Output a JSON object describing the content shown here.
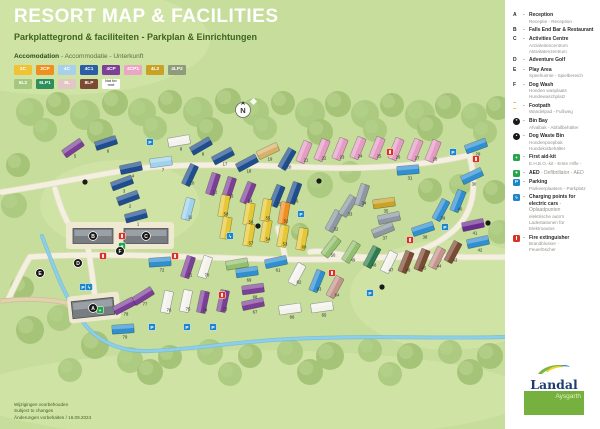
{
  "header": {
    "title": "RESORT MAP & FACILITIES",
    "subtitle": "Parkplattegrond & faciliteiten - Parkplan & Einrichtungen"
  },
  "accommodation": {
    "label_bold": "Accomodation",
    "label_rest": " - Accommodatie - Unterkunft",
    "types": [
      {
        "code": "2C",
        "bg": "#f1c232",
        "fg": "#ffffff"
      },
      {
        "code": "2CP",
        "bg": "#ee8f20",
        "fg": "#ffffff"
      },
      {
        "code": "4C",
        "bg": "#a8cfec",
        "fg": "#ffffff"
      },
      {
        "code": "4C1",
        "bg": "#2b5ea7",
        "fg": "#ffffff"
      },
      {
        "code": "4CP",
        "bg": "#7d3f98",
        "fg": "#ffffff"
      },
      {
        "code": "4CP1",
        "bg": "#e9a7c3",
        "fg": "#ffffff"
      },
      {
        "code": "4L2",
        "bg": "#c9a127",
        "fg": "#ffffff"
      },
      {
        "code": "4LP2",
        "bg": "#8f9b7a",
        "fg": "#ffffff"
      },
      {
        "code": "6L2",
        "bg": "#a5c87e",
        "fg": "#ffffff"
      },
      {
        "code": "6LP1",
        "bg": "#2f8f5b",
        "fg": "#ffffff"
      },
      {
        "code": "8L",
        "bg": "#e3c7c4",
        "fg": "#ffffff"
      },
      {
        "code": "8LP",
        "bg": "#7b4a32",
        "fg": "#ffffff"
      },
      {
        "code": "Not for rent",
        "bg": "#ffffff",
        "fg": "#5a5a5a",
        "nfr": true
      }
    ]
  },
  "facilities": [
    {
      "k": "A",
      "title": "Reception",
      "subs": [
        "Receptie - Reception"
      ]
    },
    {
      "k": "B",
      "title": "Falls End Bar & Restaurant",
      "subs": []
    },
    {
      "k": "C",
      "title": "Activities Centre",
      "subs": [
        "Activiteitencentrum",
        "Aktivitätenzentrum"
      ]
    },
    {
      "k": "D",
      "title": "Adventure Golf",
      "subs": []
    },
    {
      "k": "E",
      "title": "Play Area",
      "subs": [
        "Speelruimte - Spielbereich"
      ]
    },
    {
      "k": "F",
      "title": "Dog Wash",
      "subs": [
        "Honden wasplaats",
        "Hundewaschplatz"
      ]
    },
    {
      "icon": "footpath",
      "title": "Footpath",
      "subs": [
        "Wandelpad - Fußweg"
      ]
    },
    {
      "icon": "bin",
      "title": "Bin Bay",
      "subs": [
        "Afvalbak - Abfallbehälter"
      ]
    },
    {
      "icon": "dogbin",
      "title": "Dog Waste Bin",
      "subs": [
        "Hondenpoepbak",
        "Hundekotbehälter"
      ]
    },
    {
      "icon": "aid",
      "title": "First aid-kit",
      "subs": [
        "E.H.B.O.-kit - Erste Hilfe -"
      ]
    },
    {
      "icon": "aed",
      "title": "AED",
      "inline": " - Defibrillator - AED",
      "subs": []
    },
    {
      "icon": "p",
      "title": "Parking",
      "subs": [
        "Parkeerplaatsen - Parkplatz"
      ]
    },
    {
      "icon": "ev",
      "title": "Charging points for electric cars",
      "inline": " - Oplaadpunten",
      "subs": [
        "elektrische auto's",
        "Ladestationen für",
        "Elektroautos"
      ]
    },
    {
      "icon": "fire",
      "title": "Fire extinguisher",
      "subs": [
        "Brandblusser -",
        "Feuerlöscher"
      ]
    }
  ],
  "icon_colors": {
    "p": "#1d86c8",
    "ev": "#1d86c8",
    "aid": "#27a44a",
    "aed": "#27a44a",
    "fire": "#d83426",
    "bin": "#1a1a1a",
    "dogbin": "#1a1a1a",
    "footpath": "#ef9d3c"
  },
  "footer": {
    "lines": [
      "Wijzigingen voorbehouden",
      "Subject to changes",
      "Änderungen vorbehalten / 16.09.2024"
    ]
  },
  "logo": {
    "brand": "Landal",
    "park": "Aysgarth"
  },
  "map": {
    "compass": "N",
    "palette": {
      "navy": "#1f4e8f",
      "cer": "#2f8fd0",
      "pale": "#9fd2ef",
      "prp": "#7c3f98",
      "dprp": "#6a2d8f",
      "pink": "#e49bc4",
      "wht": "#f3f2ec",
      "gry": "#8d98a3",
      "gld": "#c9a227",
      "tan": "#d8b169",
      "yel": "#e6c735",
      "org": "#ee8f20",
      "brn": "#7b4a32",
      "rose": "#c4948c",
      "dgrn": "#2e7d4f",
      "lgrn": "#93c06f"
    },
    "lodges": [
      [
        1,
        136,
        216,
        -15,
        "navy"
      ],
      [
        2,
        128,
        198,
        -20,
        "navy"
      ],
      [
        3,
        122,
        183,
        -20,
        "navy"
      ],
      [
        4,
        131,
        168,
        -12,
        "navy"
      ],
      [
        5,
        73,
        148,
        -35,
        "prp"
      ],
      [
        6,
        106,
        143,
        -18,
        "navy"
      ],
      [
        7,
        161,
        162,
        -8,
        "pale"
      ],
      [
        8,
        179,
        141,
        -10,
        "wht"
      ],
      [
        9,
        201,
        146,
        -30,
        "navy"
      ],
      [
        10,
        190,
        175,
        -65,
        "navy"
      ],
      [
        11,
        188,
        209,
        -75,
        "pale"
      ],
      [
        12,
        213,
        184,
        -72,
        "prp"
      ],
      [
        13,
        229,
        188,
        -72,
        "prp"
      ],
      [
        14,
        248,
        193,
        -68,
        "prp"
      ],
      [
        15,
        277,
        196,
        -68,
        "navy"
      ],
      [
        16,
        294,
        193,
        -70,
        "navy"
      ],
      [
        17,
        223,
        156,
        -28,
        "navy"
      ],
      [
        18,
        247,
        163,
        -28,
        "navy"
      ],
      [
        19,
        268,
        151,
        -25,
        "tan"
      ],
      [
        20,
        287,
        159,
        -60,
        "navy"
      ],
      [
        21,
        304,
        152,
        -68,
        "pink"
      ],
      [
        22,
        322,
        150,
        -68,
        "pink"
      ],
      [
        23,
        340,
        149,
        -68,
        "pink"
      ],
      [
        24,
        358,
        148,
        -68,
        "pink"
      ],
      [
        25,
        377,
        148,
        -68,
        "pink"
      ],
      [
        26,
        396,
        149,
        -68,
        "pink"
      ],
      [
        27,
        415,
        150,
        -68,
        "pink"
      ],
      [
        28,
        433,
        151,
        -68,
        "pink"
      ],
      [
        29,
        476,
        146,
        -20,
        "cer"
      ],
      [
        30,
        472,
        176,
        -25,
        "cer"
      ],
      [
        31,
        408,
        170,
        -5,
        "cer"
      ],
      [
        32,
        334,
        221,
        -62,
        "gry"
      ],
      [
        33,
        348,
        206,
        -58,
        "gry"
      ],
      [
        34,
        362,
        195,
        -72,
        "gry"
      ],
      [
        35,
        384,
        203,
        -8,
        "gld"
      ],
      [
        36,
        389,
        218,
        -12,
        "gry"
      ],
      [
        37,
        383,
        230,
        -22,
        "gry"
      ],
      [
        38,
        423,
        229,
        -18,
        "cer"
      ],
      [
        39,
        441,
        210,
        -62,
        "cer"
      ],
      [
        40,
        458,
        201,
        -68,
        "cer"
      ],
      [
        41,
        473,
        225,
        -12,
        "dprp"
      ],
      [
        42,
        478,
        242,
        -12,
        "cer"
      ],
      [
        43,
        453,
        252,
        -62,
        "brn"
      ],
      [
        44,
        437,
        258,
        -64,
        "rose"
      ],
      [
        45,
        422,
        260,
        -68,
        "brn"
      ],
      [
        46,
        406,
        262,
        -68,
        "brn"
      ],
      [
        47,
        389,
        262,
        -64,
        "wht"
      ],
      [
        48,
        372,
        257,
        -62,
        "dgrn"
      ],
      [
        49,
        351,
        252,
        -58,
        "lgrn"
      ],
      [
        50,
        331,
        247,
        -52,
        "lgrn"
      ],
      [
        51,
        237,
        264,
        -10,
        "lgrn"
      ],
      [
        52,
        284,
        213,
        -80,
        "org"
      ],
      [
        53,
        283,
        236,
        -80,
        "yel"
      ],
      [
        54,
        266,
        231,
        -80,
        "yel"
      ],
      [
        55,
        266,
        210,
        -80,
        "yel"
      ],
      [
        56,
        249,
        214,
        -80,
        "yel"
      ],
      [
        57,
        249,
        235,
        -80,
        "yel"
      ],
      [
        58,
        224,
        206,
        -80,
        "yel"
      ],
      [
        59,
        226,
        228,
        -80,
        "yel"
      ],
      [
        60,
        302,
        239,
        -80,
        "yel"
      ],
      [
        61,
        276,
        262,
        -12,
        "cer"
      ],
      [
        62,
        297,
        274,
        -62,
        "wht"
      ],
      [
        63,
        317,
        281,
        -68,
        "cer"
      ],
      [
        64,
        335,
        287,
        -62,
        "rose"
      ],
      [
        65,
        322,
        307,
        -8,
        "wht"
      ],
      [
        66,
        290,
        309,
        -8,
        "wht"
      ],
      [
        67,
        253,
        304,
        -12,
        "prp"
      ],
      [
        68,
        253,
        289,
        -8,
        "prp"
      ],
      [
        69,
        247,
        272,
        -8,
        "cer"
      ],
      [
        70,
        205,
        267,
        -72,
        "wht"
      ],
      [
        71,
        188,
        267,
        -72,
        "prp"
      ],
      [
        72,
        160,
        262,
        -4,
        "cer"
      ],
      [
        73,
        223,
        301,
        -78,
        "prp"
      ],
      [
        74,
        203,
        302,
        -78,
        "prp"
      ],
      [
        75,
        186,
        301,
        -78,
        "wht"
      ],
      [
        76,
        167,
        302,
        -78,
        "wht"
      ],
      [
        77,
        143,
        296,
        -32,
        "prp"
      ],
      [
        78,
        124,
        306,
        -28,
        "prp"
      ],
      [
        79,
        123,
        329,
        -4,
        "cer"
      ]
    ],
    "badges": [
      [
        "p",
        150,
        142
      ],
      [
        "p",
        453,
        152
      ],
      [
        "p",
        301,
        214
      ],
      [
        "p",
        83,
        287
      ],
      [
        "p",
        152,
        327
      ],
      [
        "p",
        187,
        327
      ],
      [
        "p",
        213,
        327
      ],
      [
        "p",
        370,
        293
      ],
      [
        "p",
        445,
        227
      ],
      [
        "ev",
        89,
        287
      ],
      [
        "ev",
        230,
        236
      ],
      [
        "fire",
        103,
        256
      ],
      [
        "fire",
        175,
        256
      ],
      [
        "fire",
        390,
        152
      ],
      [
        "fire",
        410,
        240
      ],
      [
        "fire",
        122,
        236
      ],
      [
        "fire",
        332,
        273
      ],
      [
        "fire",
        222,
        295
      ],
      [
        "fire",
        476,
        159
      ],
      [
        "aid",
        100,
        310
      ],
      [
        "aed",
        122,
        246
      ],
      [
        "bin",
        488,
        223
      ],
      [
        "bin",
        382,
        287
      ],
      [
        "bin",
        258,
        226
      ],
      [
        "bin",
        85,
        182
      ],
      [
        "bin",
        319,
        181
      ]
    ],
    "letters": [
      [
        "A",
        93,
        308
      ],
      [
        "B",
        93,
        236
      ],
      [
        "C",
        146,
        236
      ],
      [
        "D",
        78,
        263
      ],
      [
        "E",
        40,
        273
      ],
      [
        "F",
        120,
        251
      ]
    ],
    "buildings": [
      [
        93,
        236,
        40,
        15,
        0
      ],
      [
        146,
        236,
        44,
        15,
        0
      ],
      [
        93,
        308,
        42,
        17,
        -6
      ]
    ]
  }
}
